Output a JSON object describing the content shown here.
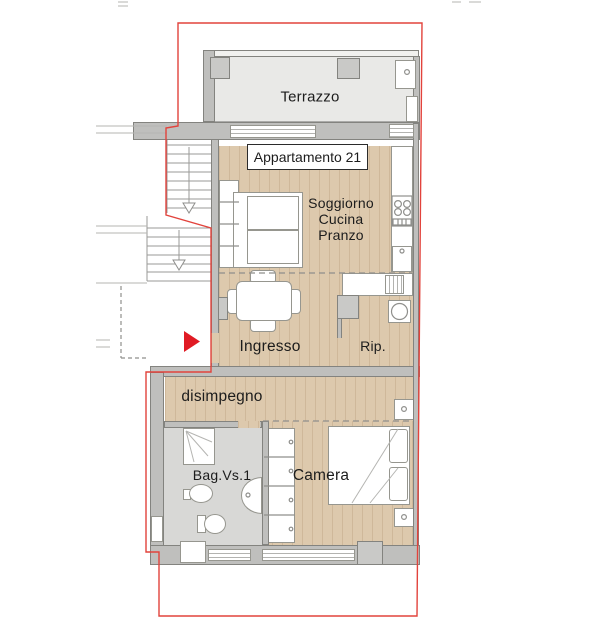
{
  "labels": {
    "terrace": "Terrazzo",
    "apartment": "Appartamento 21",
    "living1": "Soggiorno",
    "living2": "Cucina",
    "living3": "Pranzo",
    "entry": "Ingresso",
    "storage": "Rip.",
    "hallway": "disimpegno",
    "bathroom": "Bag.Vs.1",
    "bedroom": "Camera"
  },
  "colors": {
    "boundary_red": "#e2433c",
    "arrow_red": "#e01b24",
    "wood_floor": "#ddc9ad",
    "terrace_floor": "#e9e9e7",
    "bath_floor": "#d8d8d6",
    "wall_gray": "#bfbfbd",
    "wall_outline": "#83837f",
    "furniture_white": "#ffffff",
    "text_black": "#1c1c1c"
  }
}
